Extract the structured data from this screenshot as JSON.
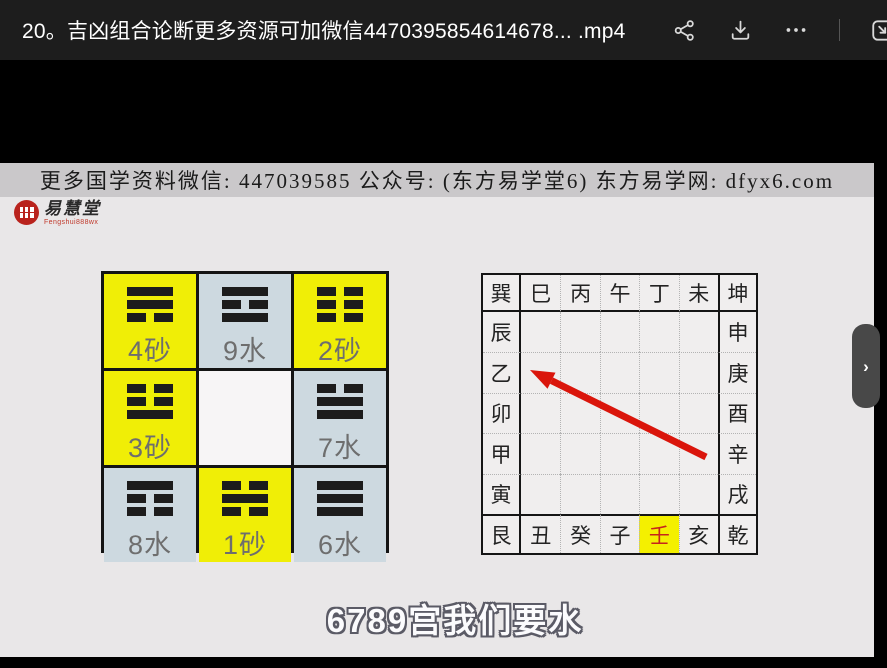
{
  "titlebar": {
    "title": "20。吉凶组合论断更多资源可加微信4470395854614678... .mp4",
    "icons": {
      "share": "share-icon",
      "download": "download-icon",
      "more": "more-icon",
      "popout": "pop-out-icon"
    }
  },
  "banner": {
    "text": "更多国学资料微信: 447039585 公众号: (东方易学堂6) 东方易学网: dfyx6.com"
  },
  "logo": {
    "name": "易慧堂",
    "subtext": "Fengshui888wx"
  },
  "luoshu": {
    "cells": [
      {
        "label": "4砂",
        "variant": "yellow",
        "trigram": [
          "solid",
          "solid",
          "broken"
        ],
        "trigram_name": "xun"
      },
      {
        "label": "9水",
        "variant": "blue",
        "trigram": [
          "solid",
          "broken",
          "solid"
        ],
        "trigram_name": "li"
      },
      {
        "label": "2砂",
        "variant": "yellow",
        "trigram": [
          "broken",
          "broken",
          "broken"
        ],
        "trigram_name": "kun"
      },
      {
        "label": "3砂",
        "variant": "yellow",
        "trigram": [
          "broken",
          "broken",
          "solid"
        ],
        "trigram_name": "zhen"
      },
      {
        "label": "",
        "variant": "white",
        "trigram": null,
        "trigram_name": ""
      },
      {
        "label": "7水",
        "variant": "blue",
        "trigram": [
          "broken",
          "solid",
          "solid"
        ],
        "trigram_name": "dui"
      },
      {
        "label": "8水",
        "variant": "blue",
        "trigram": [
          "solid",
          "broken",
          "broken"
        ],
        "trigram_name": "gen"
      },
      {
        "label": "1砂",
        "variant": "yellow",
        "trigram": [
          "broken",
          "solid",
          "broken"
        ],
        "trigram_name": "kan"
      },
      {
        "label": "6水",
        "variant": "blue",
        "trigram": [
          "solid",
          "solid",
          "solid"
        ],
        "trigram_name": "qian"
      }
    ]
  },
  "compass": {
    "top": [
      "巽",
      "巳",
      "丙",
      "午",
      "丁",
      "未",
      "坤"
    ],
    "middle_rows": [
      [
        "辰",
        "申"
      ],
      [
        "乙",
        "庚"
      ],
      [
        "卯",
        "酉"
      ],
      [
        "甲",
        "辛"
      ],
      [
        "寅",
        "戌"
      ]
    ],
    "bottom": [
      "艮",
      "丑",
      "癸",
      "子",
      "壬",
      "亥",
      "乾"
    ],
    "highlight_char": "壬"
  },
  "arrow": {
    "tail": [
      706,
      294
    ],
    "tip": [
      530,
      207
    ],
    "color": "#da150b"
  },
  "subtitle": {
    "text": "6789宫我们要水"
  },
  "flyout": {
    "chevron": "›"
  },
  "colors": {
    "titlebar_bg": "#1d1d1d",
    "slide_bg": "#e9e7e8",
    "banner_bg": "#cac8ca",
    "cell_yellow": "#f0ee06",
    "cell_blue": "#cdd9e0",
    "cell_white": "#f7f5f6",
    "highlight_yellow": "#f4f000",
    "highlight_text_red": "#c5251c",
    "arrow_red": "#da150b",
    "logo_red": "#b9231d"
  }
}
